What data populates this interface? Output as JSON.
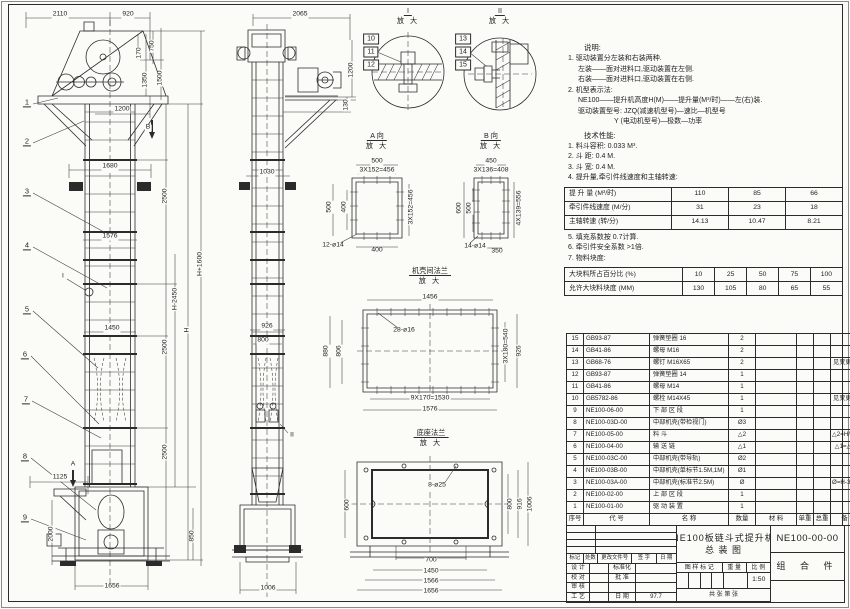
{
  "colors": {
    "paper": "#fbfbf7",
    "line": "#2b2b2b"
  },
  "notes": {
    "title": "说明:",
    "lines": [
      {
        "t": "1. 驱动装置分左装和右装两种.",
        "l": 0
      },
      {
        "t": "左装——面对进料口,驱动装置在左侧.",
        "l": 1
      },
      {
        "t": "右装——面对进料口,驱动装置在右侧.",
        "l": 1
      },
      {
        "t": "2. 机型表示法:",
        "l": 0
      },
      {
        "t": "NE100——提升机高度H(M)——提升量(M³/时)——左(右)装.",
        "l": 1
      },
      {
        "t": "驱动装置型号: JZQ(减速机型号)—速比—机型号",
        "l": 1
      },
      {
        "t": "Y (电动机型号)—极数—功率",
        "l": 2
      }
    ]
  },
  "tech": {
    "title": "技术性能:",
    "lines_before": [
      {
        "t": "1. 料斗容积: 0.033 M³.",
        "l": 0
      },
      {
        "t": "2. 斗  距: 0.4 M.",
        "l": 0
      },
      {
        "t": "3. 斗  宽: 0.4 M.",
        "l": 0
      },
      {
        "t": "4. 提升量,牵引件线速度和主轴转速:",
        "l": 0
      }
    ],
    "lines_after": [
      {
        "t": "5. 填充系数按 0.7计算.",
        "l": 0
      },
      {
        "t": "6. 牵引件安全系数 >1倍.",
        "l": 0
      },
      {
        "t": "7. 物料块度:",
        "l": 0
      }
    ]
  },
  "lift_table": {
    "rows": [
      {
        "label": "提 升 量  (M³/时)",
        "values": [
          "110",
          "85",
          "66"
        ]
      },
      {
        "label": "牵引件线速度 (M/分)",
        "values": [
          "31",
          "23",
          "18"
        ]
      },
      {
        "label": "主轴转速  (转/分)",
        "values": [
          "14.13",
          "10.47",
          "8.21"
        ]
      }
    ]
  },
  "lump_table": {
    "rows": [
      {
        "label": "大块料所占百分比 (%)",
        "values": [
          "10",
          "25",
          "50",
          "75",
          "100"
        ]
      },
      {
        "label": "允许大块料块度 (MM)",
        "values": [
          "130",
          "105",
          "80",
          "65",
          "55"
        ]
      }
    ]
  },
  "bom": {
    "headers": [
      "序号",
      "代  号",
      "名  称",
      "数量",
      "材  料",
      "单重",
      "总重",
      "备  注"
    ],
    "rows": [
      [
        "15",
        "GB93-87",
        "弹簧垫圈 16",
        "2",
        "",
        "",
        "",
        ""
      ],
      [
        "14",
        "GB41-86",
        "螺母 M16",
        "2",
        "",
        "",
        "",
        ""
      ],
      [
        "13",
        "GB68-76",
        "螺钉 M16X65",
        "2",
        "",
        "",
        "",
        "见变更通单"
      ],
      [
        "12",
        "GB93-87",
        "弹簧垫圈 14",
        "1",
        "",
        "",
        "",
        ""
      ],
      [
        "11",
        "GB41-86",
        "螺母 M14",
        "1",
        "",
        "",
        "",
        ""
      ],
      [
        "10",
        "GB5782-86",
        "螺栓 M14X45",
        "1",
        "",
        "",
        "",
        "见变更通单"
      ],
      [
        "9",
        "NE100-06-00",
        "下 部 区 段",
        "1",
        "",
        "",
        "",
        ""
      ],
      [
        "8",
        "NE100-03D-00",
        "中部机壳(带检视门)",
        "Ø3",
        "",
        "",
        "",
        ""
      ],
      [
        "7",
        "NE100-05-00",
        "料 斗",
        "△2",
        "",
        "",
        "",
        "△2=H/0.2+5.75"
      ],
      [
        "6",
        "NE100-04-00",
        "输 送 链",
        "△1",
        "",
        "",
        "",
        "△1=△2X4"
      ],
      [
        "5",
        "NE100-03C-00",
        "中部机壳(带导轨)",
        "Ø2",
        "",
        "",
        "",
        ""
      ],
      [
        "4",
        "NE100-03B-00",
        "中部机壳(单标节1.5M,1M)",
        "Ø1",
        "",
        "",
        "",
        ""
      ],
      [
        "3",
        "NE100-03A-00",
        "中部机壳(标准节2.5M)",
        "Ø",
        "",
        "",
        "",
        "Ø=H-3.15/2.5"
      ],
      [
        "2",
        "NE100-02-00",
        "上 部 区 段",
        "1",
        "",
        "",
        "",
        ""
      ],
      [
        "1",
        "NE100-01-00",
        "驱 动 装 置",
        "1",
        "",
        "",
        "",
        ""
      ]
    ]
  },
  "title_block": {
    "product_title_line1": "NE100板链斗式提升机",
    "product_title_line2": "总  装  图",
    "drawing_no": "NE100-00-00",
    "assembly_type": "组 合 件",
    "rev_headers": [
      "标记",
      "处数",
      "更改文件号",
      "签 字",
      "日 期"
    ],
    "roles": [
      {
        "l": "设 计",
        "r": "标准化",
        "rv": ""
      },
      {
        "l": "校 对",
        "r": "批 准",
        "rv": ""
      },
      {
        "l": "审 核",
        "r": "",
        "rv": ""
      },
      {
        "l": "工 艺",
        "r": "日 期",
        "rv": "97.7"
      }
    ],
    "mark_label": "图 样 标 记",
    "weight_label": "重 量",
    "scale_label": "比 例",
    "scale": "1:50",
    "sheet_label": "共   张  第   张"
  },
  "drawing": {
    "view_titles": [
      {
        "t1": "I",
        "t2": "放 大",
        "x": 408,
        "y": 6
      },
      {
        "t1": "II",
        "t2": "放 大",
        "x": 500,
        "y": 6
      },
      {
        "t1": "A 向",
        "t2": "放 大",
        "x": 377,
        "y": 131
      },
      {
        "t1": "B 向",
        "t2": "放 大",
        "x": 491,
        "y": 131
      },
      {
        "t1": "机壳间法兰",
        "t2": "放 大",
        "x": 430,
        "y": 266
      },
      {
        "t1": "底座法兰",
        "t2": "放 大",
        "x": 431,
        "y": 428
      }
    ],
    "labels": [
      {
        "t": "2110",
        "x": 60,
        "y": 15
      },
      {
        "t": "920",
        "x": 128,
        "y": 15
      },
      {
        "t": "170",
        "x": 140,
        "y": 53,
        "r": 1
      },
      {
        "t": "750",
        "x": 153,
        "y": 46,
        "r": 1
      },
      {
        "t": "1350",
        "x": 146,
        "y": 80,
        "r": 1
      },
      {
        "t": "1500",
        "x": 161,
        "y": 78,
        "r": 1
      },
      {
        "t": "1200",
        "x": 122,
        "y": 110
      },
      {
        "t": "B",
        "x": 148,
        "y": 128
      },
      {
        "t": "1680",
        "x": 110,
        "y": 167
      },
      {
        "t": "2500",
        "x": 166,
        "y": 196,
        "r": 1
      },
      {
        "t": "1576",
        "x": 110,
        "y": 237
      },
      {
        "t": "H-2450",
        "x": 176,
        "y": 299,
        "r": 1
      },
      {
        "t": "H",
        "x": 188,
        "y": 330,
        "r": 1
      },
      {
        "t": "H+1600",
        "x": 201,
        "y": 264,
        "r": 1
      },
      {
        "t": "1450",
        "x": 112,
        "y": 329
      },
      {
        "t": "2500",
        "x": 166,
        "y": 347,
        "r": 1
      },
      {
        "t": "2500",
        "x": 166,
        "y": 452,
        "r": 1
      },
      {
        "t": "1125",
        "x": 60,
        "y": 478
      },
      {
        "t": "A",
        "x": 73,
        "y": 465
      },
      {
        "t": "2000",
        "x": 52,
        "y": 534,
        "r": 1
      },
      {
        "t": "850",
        "x": 193,
        "y": 536,
        "r": 1
      },
      {
        "t": "1656",
        "x": 112,
        "y": 587
      },
      {
        "t": "I",
        "x": 63,
        "y": 277
      },
      {
        "t": "2065",
        "x": 300,
        "y": 15
      },
      {
        "t": "1200",
        "x": 352,
        "y": 70,
        "r": 1
      },
      {
        "t": "130",
        "x": 347,
        "y": 105,
        "r": 1
      },
      {
        "t": "1030",
        "x": 267,
        "y": 173
      },
      {
        "t": "926",
        "x": 267,
        "y": 327
      },
      {
        "t": "800",
        "x": 263,
        "y": 341
      },
      {
        "t": "II",
        "x": 292,
        "y": 436
      },
      {
        "t": "1006",
        "x": 268,
        "y": 589
      },
      {
        "t": "500",
        "x": 377,
        "y": 162
      },
      {
        "t": "3X152=456",
        "x": 377,
        "y": 171
      },
      {
        "t": "500",
        "x": 330,
        "y": 207,
        "r": 1
      },
      {
        "t": "400",
        "x": 345,
        "y": 207,
        "r": 1
      },
      {
        "t": "3X152=456",
        "x": 412,
        "y": 207,
        "r": 1
      },
      {
        "t": "12-ø14",
        "x": 333,
        "y": 246
      },
      {
        "t": "400",
        "x": 377,
        "y": 251
      },
      {
        "t": "450",
        "x": 491,
        "y": 162
      },
      {
        "t": "3X136=408",
        "x": 491,
        "y": 171
      },
      {
        "t": "600",
        "x": 460,
        "y": 208,
        "r": 1
      },
      {
        "t": "500",
        "x": 470,
        "y": 208,
        "r": 1
      },
      {
        "t": "4X139=556",
        "x": 520,
        "y": 208,
        "r": 1
      },
      {
        "t": "14-ø14",
        "x": 475,
        "y": 247
      },
      {
        "t": "350",
        "x": 497,
        "y": 252
      },
      {
        "t": "1456",
        "x": 430,
        "y": 298
      },
      {
        "t": "28-ø16",
        "x": 404,
        "y": 331
      },
      {
        "t": "880",
        "x": 327,
        "y": 351,
        "r": 1
      },
      {
        "t": "806",
        "x": 340,
        "y": 351,
        "r": 1
      },
      {
        "t": "3X180=540",
        "x": 507,
        "y": 346,
        "r": 1
      },
      {
        "t": "926",
        "x": 520,
        "y": 351,
        "r": 1
      },
      {
        "t": "9X170=1530",
        "x": 430,
        "y": 399
      },
      {
        "t": "1576",
        "x": 430,
        "y": 410
      },
      {
        "t": "8-ø25",
        "x": 437,
        "y": 486
      },
      {
        "t": "600",
        "x": 348,
        "y": 505,
        "r": 1
      },
      {
        "t": "800",
        "x": 511,
        "y": 504,
        "r": 1
      },
      {
        "t": "916",
        "x": 521,
        "y": 504,
        "r": 1
      },
      {
        "t": "1006",
        "x": 531,
        "y": 504,
        "r": 1
      },
      {
        "t": "700",
        "x": 431,
        "y": 561
      },
      {
        "t": "1450",
        "x": 431,
        "y": 572
      },
      {
        "t": "1566",
        "x": 431,
        "y": 582
      },
      {
        "t": "1656",
        "x": 431,
        "y": 592
      }
    ],
    "balloons": [
      {
        "n": "1",
        "x": 27,
        "y": 103
      },
      {
        "n": "2",
        "x": 27,
        "y": 142
      },
      {
        "n": "3",
        "x": 27,
        "y": 192
      },
      {
        "n": "4",
        "x": 27,
        "y": 246
      },
      {
        "n": "5",
        "x": 27,
        "y": 310
      },
      {
        "n": "6",
        "x": 25,
        "y": 355
      },
      {
        "n": "7",
        "x": 26,
        "y": 400
      },
      {
        "n": "8",
        "x": 25,
        "y": 457
      },
      {
        "n": "9",
        "x": 25,
        "y": 518
      }
    ],
    "boxed_balloons": [
      {
        "n": "10",
        "x": 371,
        "y": 39
      },
      {
        "n": "11",
        "x": 371,
        "y": 52
      },
      {
        "n": "12",
        "x": 371,
        "y": 65
      },
      {
        "n": "13",
        "x": 463,
        "y": 39
      },
      {
        "n": "14",
        "x": 463,
        "y": 52
      },
      {
        "n": "15",
        "x": 463,
        "y": 65
      }
    ]
  }
}
